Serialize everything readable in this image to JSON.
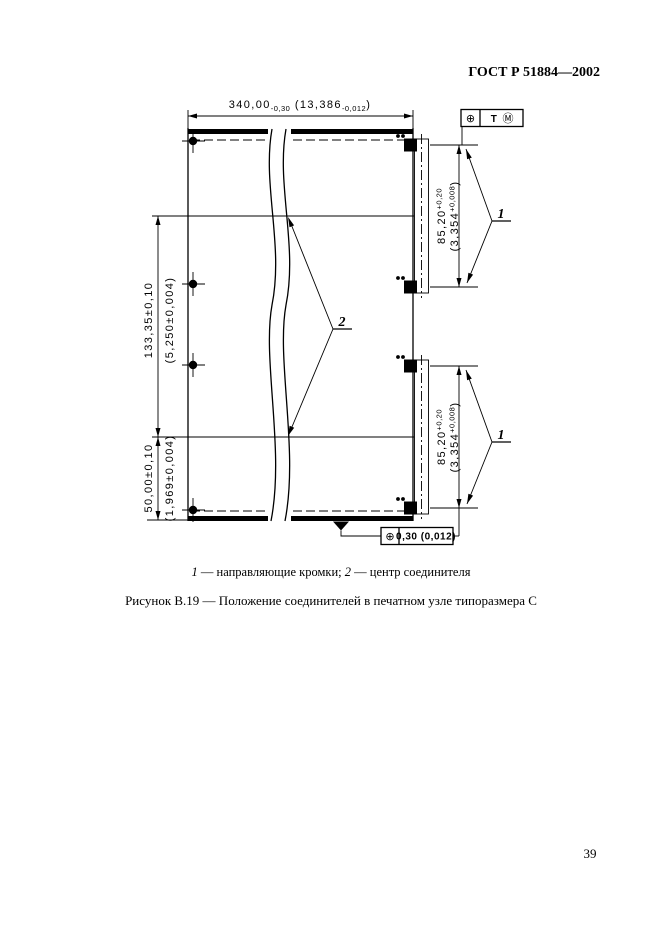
{
  "page": {
    "header": "ГОСТ Р 51884—2002",
    "page_number": "39"
  },
  "figure": {
    "legend": {
      "num1": "1",
      "text1": " — направляющие кромки; ",
      "num2": "2",
      "text2": " — центр соединителя"
    },
    "caption": "Рисунок В.19 — Положение соединителей в печатном узле типоразмера С"
  },
  "dimensions": {
    "top": {
      "mm": "340,00",
      "mm_tol": "-0,30",
      "in": " (13,386",
      "in_tol": "-0,012",
      "close": ")"
    },
    "left_span": {
      "mm": "133,35±0,10",
      "in": "(5,250±0,004)"
    },
    "left_bottom": {
      "mm": "50,00±0,10",
      "in": "(1,969±0,004)"
    },
    "right_upper": {
      "mm": "85,20",
      "mm_tol": "+0,20",
      "in": "(3,354",
      "in_tol": "+0,008",
      "close": ")"
    },
    "right_lower": {
      "mm": "85,20",
      "mm_tol": "+0,20",
      "in": "(3,354",
      "in_tol": "+0,008",
      "close": ")"
    }
  },
  "symbols": {
    "datum_frame": {
      "position": "⊕",
      "tolerance": "Т",
      "modifier": "Ⓜ"
    },
    "tolerance_frame": {
      "position": "⊕",
      "value": "0,30 (0,012)"
    },
    "callout_1": "1",
    "callout_2": "2"
  },
  "colors": {
    "ink": "#000000",
    "paper": "#ffffff"
  }
}
